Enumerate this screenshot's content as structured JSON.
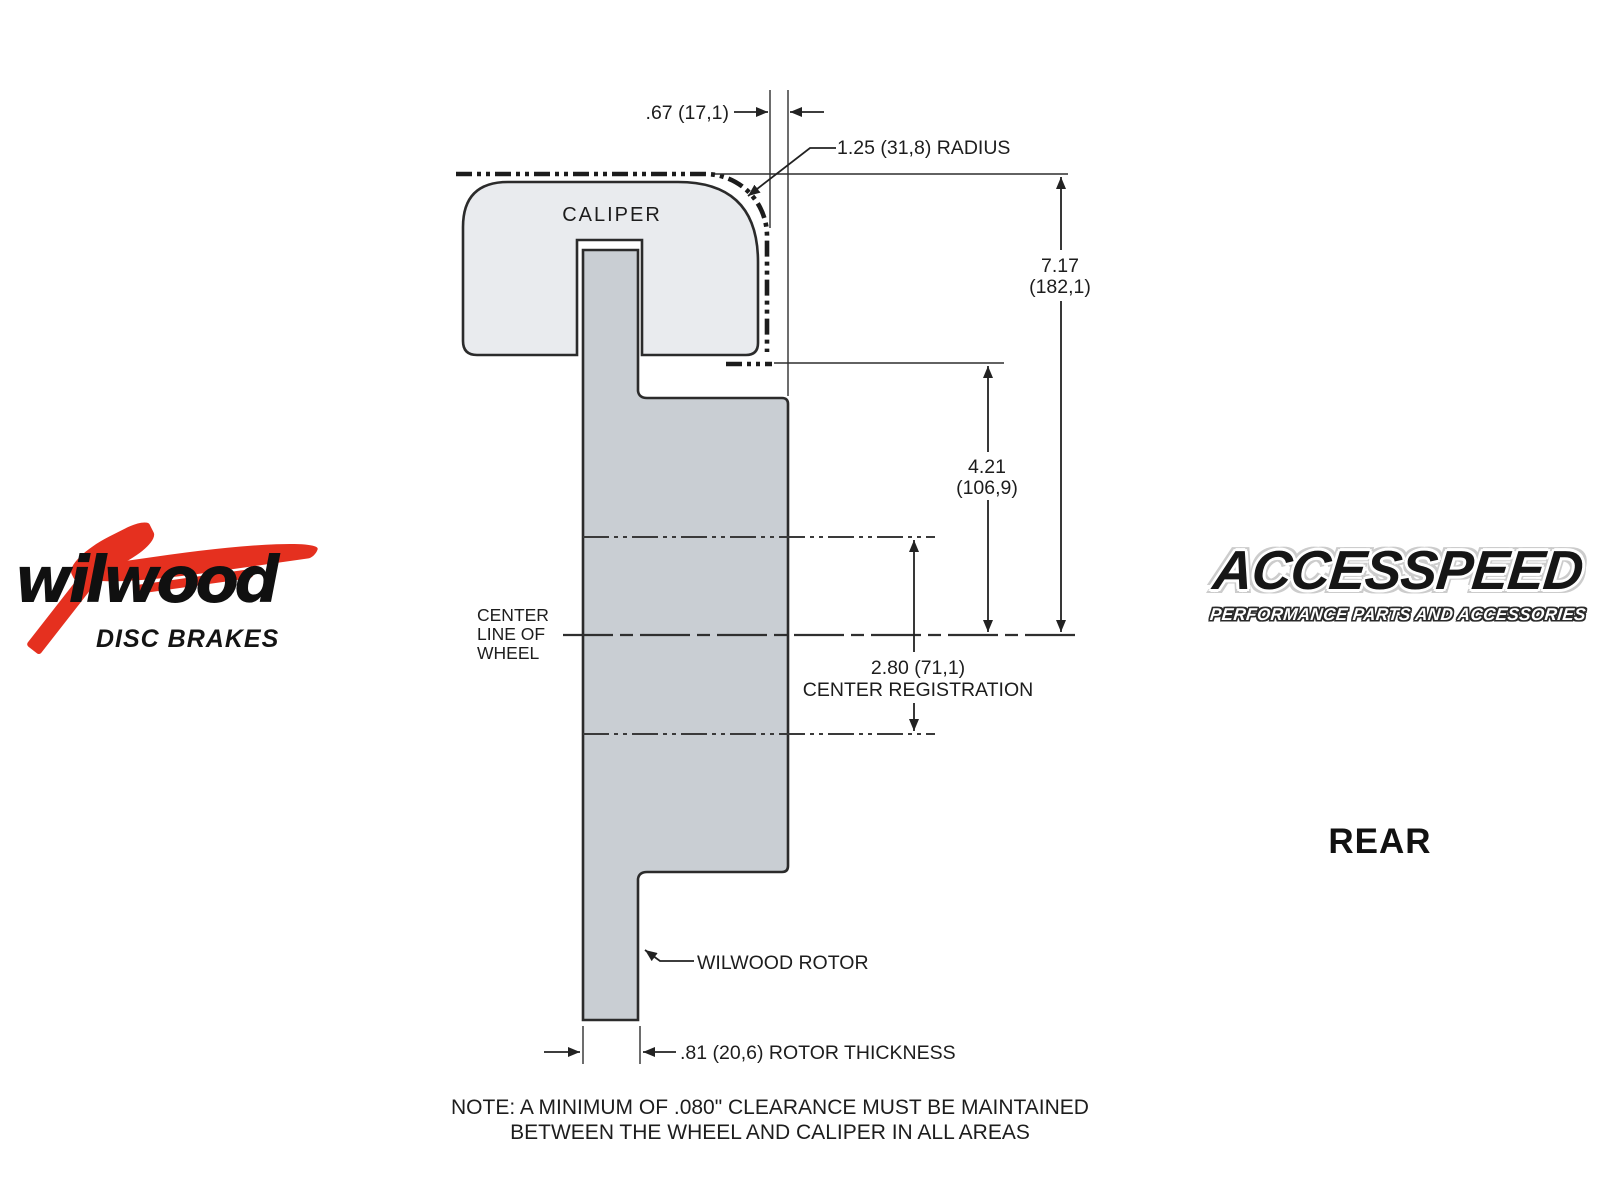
{
  "diagram": {
    "caliper_label": "CALIPER",
    "center_line_label": {
      "lines": [
        "CENTER",
        "LINE OF",
        "WHEEL"
      ]
    },
    "dims": {
      "caliper_wheel_gap": {
        "text": ".67 (17,1)"
      },
      "radius": {
        "text": "1.25 (31,8) RADIUS"
      },
      "overall_height": {
        "value": "7.17",
        "mm": "(182,1)"
      },
      "caliper_to_center": {
        "value": "4.21",
        "mm": "(106,9)"
      },
      "center_registration": {
        "value": "2.80 (71,1)",
        "label": "CENTER REGISTRATION"
      },
      "rotor_thickness": {
        "text": ".81 (20,6) ROTOR THICKNESS"
      }
    },
    "rotor_label": "WILWOOD ROTOR",
    "note": {
      "line1": "NOTE: A MINIMUM OF .080\" CLEARANCE MUST BE MAINTAINED",
      "line2": "BETWEEN THE WHEEL AND CALIPER IN ALL AREAS"
    }
  },
  "wilwood_logo": {
    "name": "wilwood",
    "tagline": "DISC BRAKES",
    "red": "#e5301f"
  },
  "accesspeed_logo": {
    "name": "ACCESSPEED",
    "tagline": "PERFORMANCE PARTS AND ACCESSORIES"
  },
  "position_label": "REAR",
  "colors": {
    "caliper_fill": "#e9ebee",
    "rotor_fill": "#c9ced3",
    "line": "#2b2b2b"
  }
}
